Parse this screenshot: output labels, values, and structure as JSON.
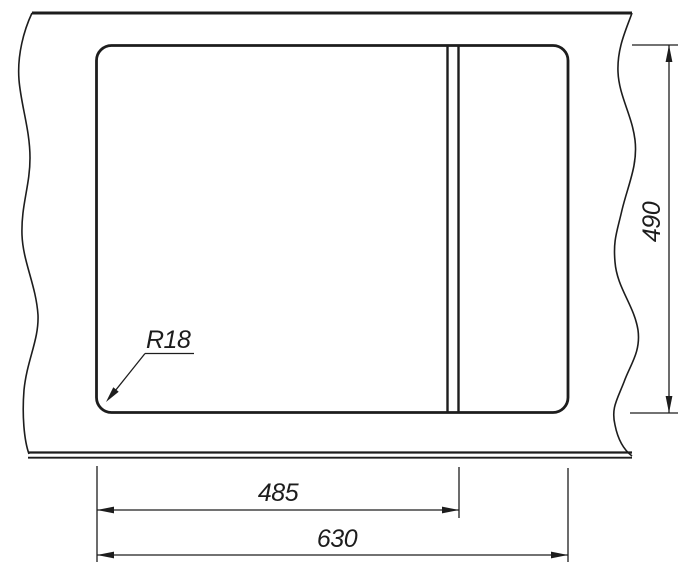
{
  "drawing": {
    "colors": {
      "line": "#1d1d1d",
      "background": "#ffffff"
    },
    "callouts": {
      "corner_radius": "R18",
      "bowl_width": "485",
      "overall_width": "630",
      "overall_height": "490"
    }
  }
}
